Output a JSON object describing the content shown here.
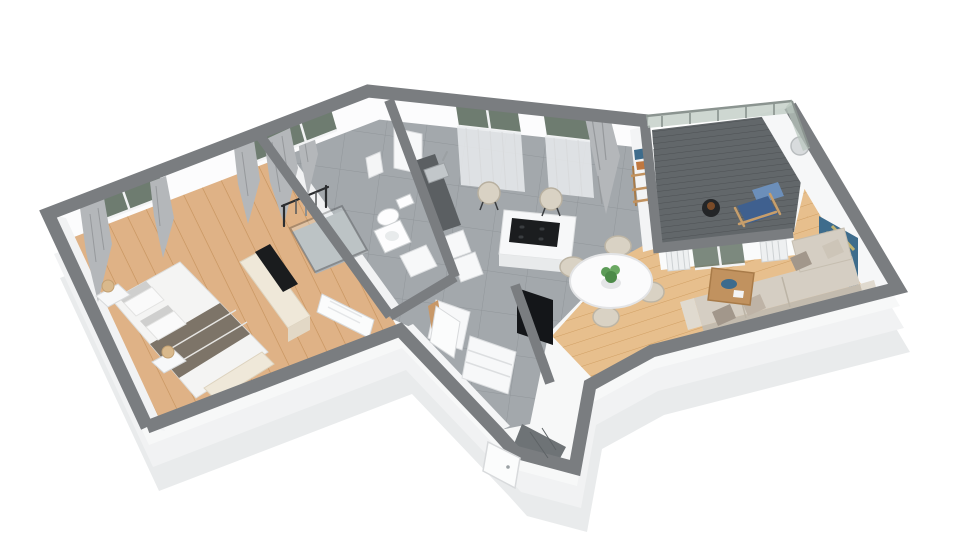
{
  "scene": {
    "kind": "3d-isometric-floor-plan-render",
    "background": "#ffffff",
    "rooms": [
      {
        "id": "bedroom",
        "floor": "light-oak-wood"
      },
      {
        "id": "bathroom",
        "floor": "grey-tile"
      },
      {
        "id": "kitchen",
        "floor": "grey-tile"
      },
      {
        "id": "hallway",
        "floor": "grey-tile"
      },
      {
        "id": "living-dining",
        "floor": "light-oak-wood"
      },
      {
        "id": "balcony",
        "floor": "dark-wood-decking"
      }
    ],
    "furniture": {
      "bedroom": [
        "double-bed",
        "grey-throw-blanket",
        "pillows",
        "nightstand-left",
        "nightstand-right",
        "wooden-ball-lamps",
        "tv-sideboard",
        "tv",
        "foot-bench",
        "clothes-rack",
        "curtained-windows"
      ],
      "bathroom": [
        "walk-in-shower-glass",
        "toilet",
        "washbasin",
        "vanity-cabinet",
        "towel",
        "curtained-window"
      ],
      "kitchen": [
        "tall-cabinet",
        "counter-with-steel-sink",
        "base-cabinets",
        "kitchen-island",
        "black-cooktop",
        "two-bar-stools",
        "sheer-curtain-windows",
        "tied-drape"
      ],
      "hallway": [
        "closet-with-open-door",
        "drawer-chest",
        "tv-partition-wall",
        "flat-tv-screen",
        "entry-vestibule",
        "entry-door"
      ],
      "living_dining": [
        "round-dining-table",
        "four-dining-chairs",
        "green-plant-centerpiece",
        "corner-sofa",
        "throw-pillows",
        "wood-coffee-table",
        "blue-decor-tray",
        "wall-painting",
        "round-wall-opening",
        "radiators",
        "ladder-wall-shelf",
        "sliding-glass-balcony-door"
      ],
      "balcony": [
        "glass-railing",
        "wood-armchair-blue-cushions",
        "black-side-table"
      ]
    }
  },
  "colors": {
    "wallTop": "#7a7d80",
    "innerFace": "#fcfcfd",
    "outerFace1": "#f7f8f8",
    "outerFace2": "#f1f2f3",
    "plinthShadow": "#e9ebec",
    "woodBedroom": "#dfb286",
    "woodBedroomLine": "#c6925c",
    "woodLiving": "#e7bf8d",
    "woodLivingLine": "#d09f63",
    "tile": "#a3a8ac",
    "tileLine": "#91969a",
    "deck": "#62676a",
    "deckLine": "#4d5154",
    "vestibuleTile": "#6e7376",
    "glass": "#6e7c70",
    "railGlass": "#b9c6bd",
    "frameWhite": "#f2f3f4",
    "curtain": "#b4b7ba",
    "sheer": "#e9ebed",
    "duvet": "#f4f4f3",
    "blanket": "#7d7468",
    "pillowGray": "#cfcfce",
    "cream": "#efe8d9",
    "white": "#f7f8f9",
    "whiteShade": "#e8eaeb",
    "counterDark": "#5b5f62",
    "steel": "#c2c7ca",
    "tvBlack": "#141619",
    "cooktop": "#1b1d1f",
    "sofa": "#d5cec3",
    "sofaShade": "#c3bbae",
    "cushionA": "#a2978b",
    "cushionB": "#beb3a6",
    "tableWood": "#c1925f",
    "tableWoodDark": "#a87b49",
    "decorBlue": "#3c6b8d",
    "chairBeige": "#d9d2c4",
    "plantGreen": "#5c9b57",
    "balconyChairBlue": "#3f608f",
    "balconyChairBlueLight": "#6c8fba",
    "chairWoodFrame": "#c79e6b",
    "sideTableBlack": "#232527",
    "radiator": "#eef0f1",
    "paintingBlue": "#3e6c8c",
    "paintingYellow": "#d8c06c",
    "lampWood": "#d9b98c",
    "doorWhite": "#fbfcfc",
    "closetWoodInterior": "#c89868",
    "holeGray": "#d8dbdd"
  }
}
